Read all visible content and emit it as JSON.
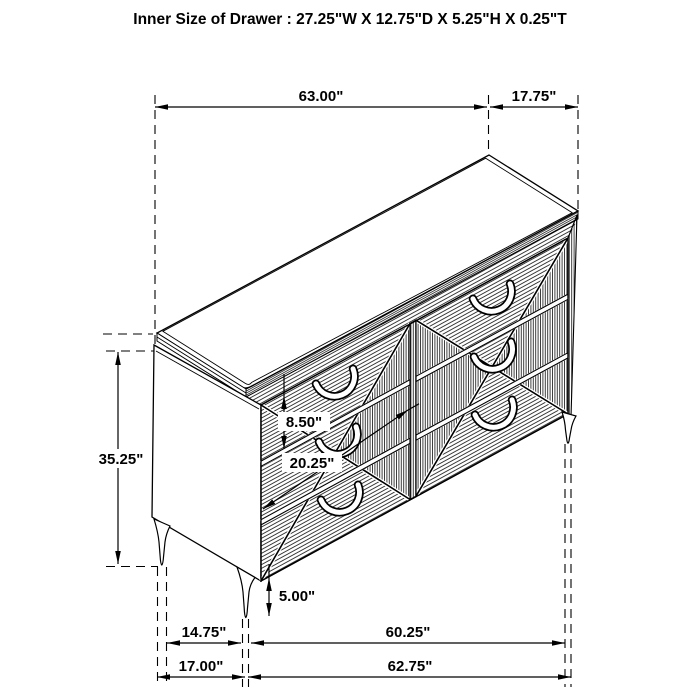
{
  "title": "Inner Size of Drawer : 27.25\"W X 12.75\"D X 5.25\"H X 0.25\"T",
  "colors": {
    "line": "#000000",
    "background": "#ffffff"
  },
  "dimensions": {
    "top_width": "63.00\"",
    "top_depth": "17.75\"",
    "overall_height": "35.25\"",
    "top_drawer_front_height": "8.50\"",
    "lower_drawers_height": "20.25\"",
    "leg_height": "5.00\"",
    "leg_inset_depth": "14.75\"",
    "leg_span_width": "60.25\"",
    "overall_base_depth": "17.00\"",
    "overall_base_width": "62.75\""
  }
}
